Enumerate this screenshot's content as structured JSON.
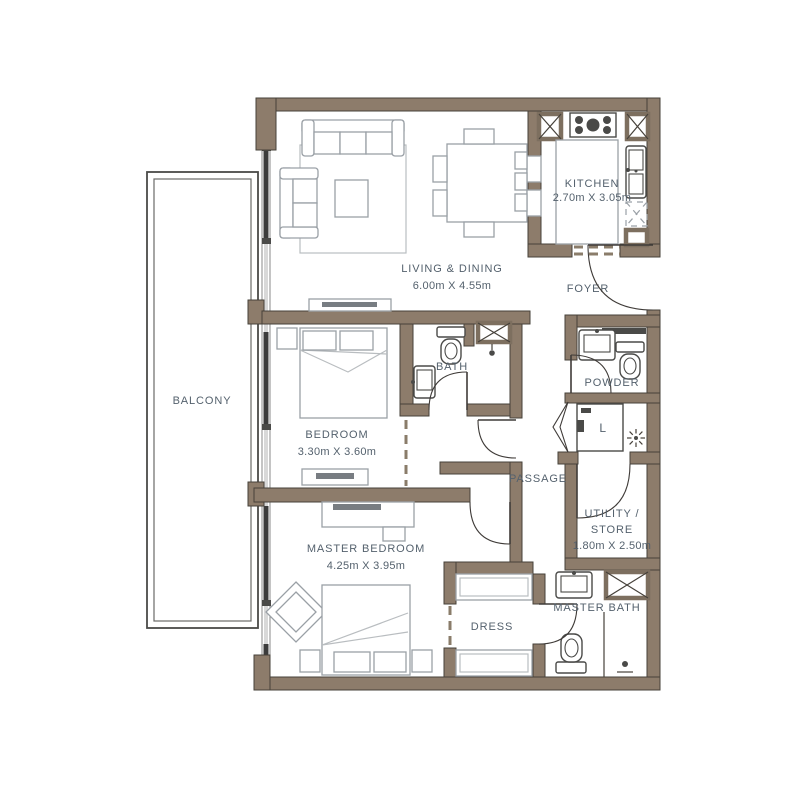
{
  "plan": {
    "colors": {
      "wall": "#8d7c6b",
      "outline": "#46413a",
      "furniture_line": "#9aa0a6",
      "label_text": "#54616d",
      "glazing": "#3c3c3c"
    },
    "rooms": {
      "balcony": {
        "label": "BALCONY"
      },
      "living_dining": {
        "label": "LIVING & DINING",
        "dims": "6.00m X 4.55m"
      },
      "kitchen": {
        "label": "KITCHEN",
        "dims": "2.70m X 3.05m"
      },
      "foyer": {
        "label": "FOYER"
      },
      "bath": {
        "label": "BATH"
      },
      "powder": {
        "label": "POWDER"
      },
      "passage": {
        "label": "PASSAGE"
      },
      "bedroom": {
        "label": "BEDROOM",
        "dims": "3.30m X 3.60m"
      },
      "utility": {
        "label_1": "UTILITY /",
        "label_2": "STORE",
        "dims": "1.80m X 2.50m"
      },
      "master_bedroom": {
        "label": "MASTER BEDROOM",
        "dims": "4.25m X 3.95m"
      },
      "dress": {
        "label": "DRESS"
      },
      "master_bath": {
        "label": "MASTER BATH"
      },
      "laundry_closet": {
        "label": "L"
      }
    }
  }
}
